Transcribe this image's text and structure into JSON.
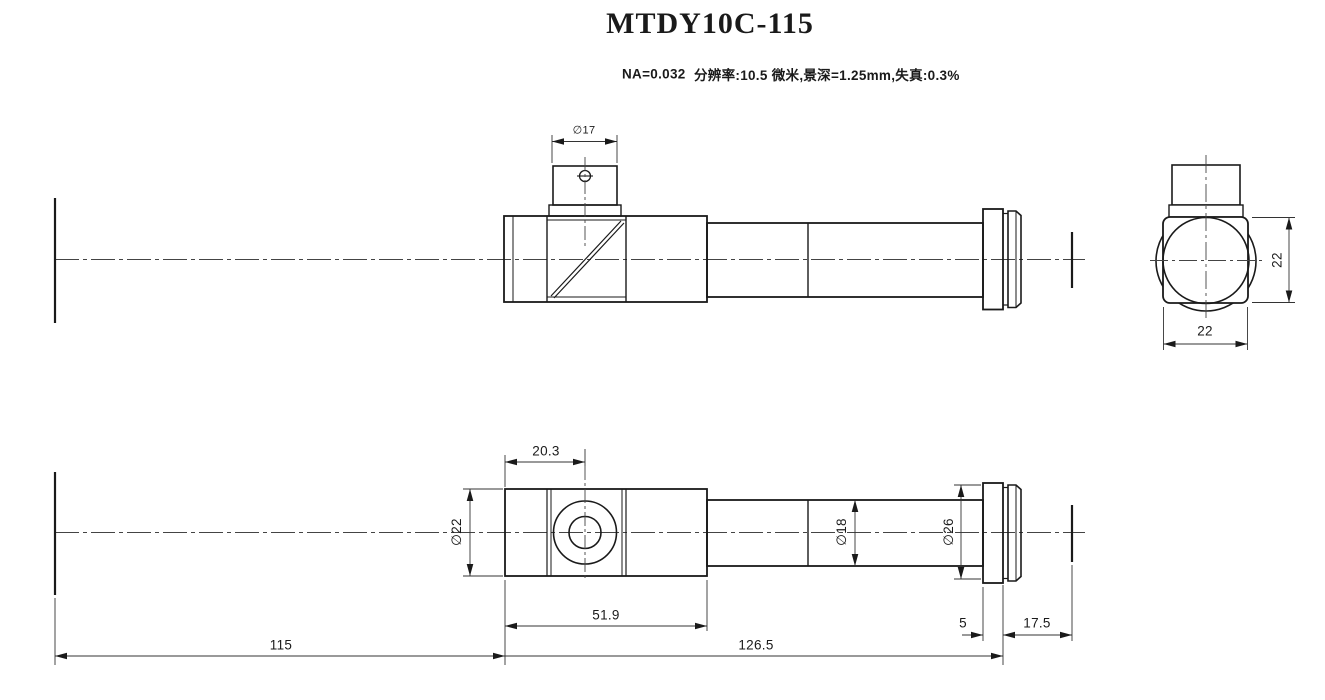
{
  "drawing": {
    "title": "MTDY10C-115",
    "spec_na": "NA=0.032",
    "spec_detail": "分辨率:10.5 微米,景深=1.25mm,失真:0.3%"
  },
  "dims": {
    "eyepiece_dia": "∅17",
    "head_width": "22",
    "head_height": "22",
    "port_offset": "20.3",
    "body_dia": "∅22",
    "tube_dia": "∅18",
    "flange_dia": "∅26",
    "head_length": "51.9",
    "flange_width": "5",
    "working_distance": "17.5",
    "image_distance": "115",
    "barrel_length": "126.5"
  }
}
